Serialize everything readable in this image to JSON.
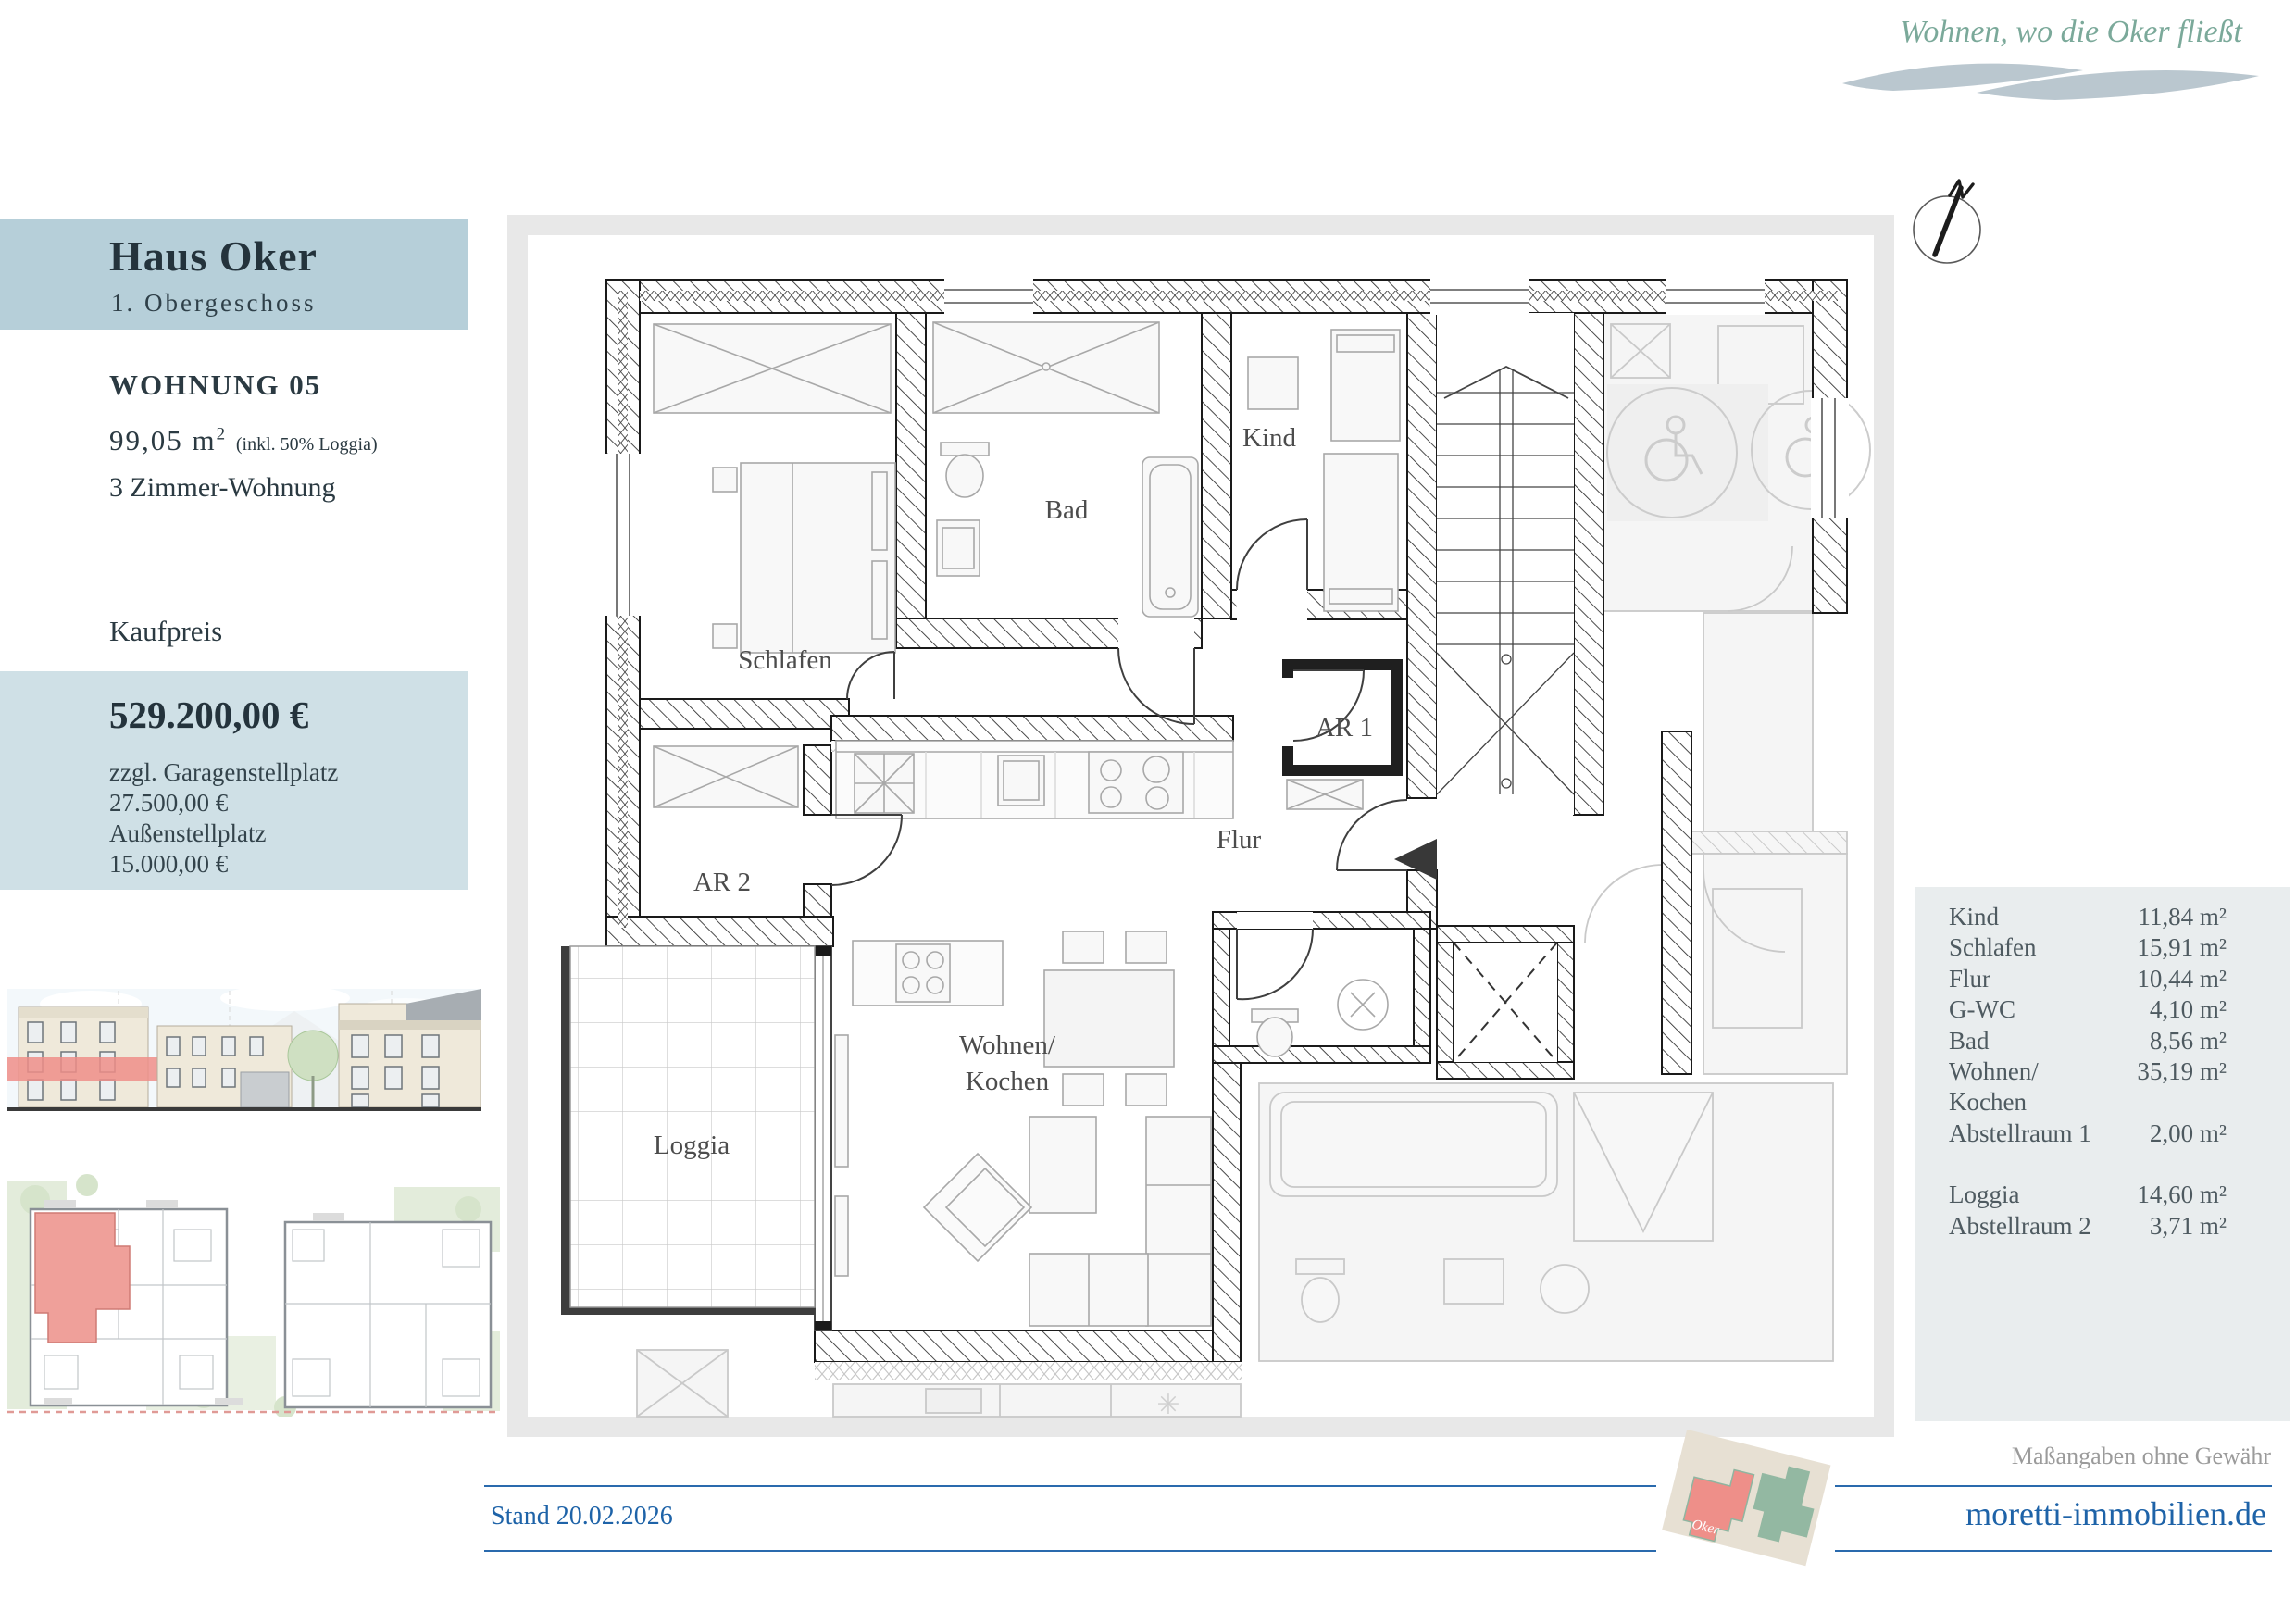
{
  "tagline": "Wohnen, wo die Oker fließt",
  "header": {
    "building": "Haus Oker",
    "floor": "1. Obergeschoss"
  },
  "apartment": {
    "title": "WOHNUNG 05",
    "area_main": "99,05 m",
    "area_sup": "2",
    "area_note": "(inkl. 50% Loggia)",
    "rooms": "3 Zimmer-Wohnung"
  },
  "price": {
    "label": "Kaufpreis",
    "amount": "529.200,00 €",
    "extra1": "zzgl. Garagenstellplatz",
    "extra2": "27.500,00 €",
    "extra3": "Außenstellplatz",
    "extra4": "15.000,00 €"
  },
  "plan_labels": {
    "schlafen": "Schlafen",
    "bad": "Bad",
    "kind": "Kind",
    "ar1": "AR 1",
    "ar2": "AR 2",
    "flur": "Flur",
    "wohnen": "Wohnen/",
    "kochen": "Kochen",
    "loggia": "Loggia"
  },
  "areas": {
    "rows": [
      {
        "label": "Kind",
        "value": "11,84 m²"
      },
      {
        "label": "Schlafen",
        "value": "15,91 m²"
      },
      {
        "label": "Flur",
        "value": "10,44 m²"
      },
      {
        "label": "G-WC",
        "value": "4,10 m²"
      },
      {
        "label": "Bad",
        "value": "8,56 m²"
      },
      {
        "label": "Wohnen/",
        "value": "35,19 m²"
      },
      {
        "label": "Kochen",
        "value": ""
      },
      {
        "label": "Abstellraum 1",
        "value": "2,00 m²"
      },
      {
        "label": "Loggia",
        "value": "14,60 m²"
      },
      {
        "label": "Abstellraum 2",
        "value": "3,71 m²"
      }
    ]
  },
  "footer": {
    "stand": "Stand 20.02.2026",
    "disclaimer": "Maßangaben ohne Gewähr",
    "website": "moretti-immobilien.de",
    "logo_label": "Oker"
  },
  "colors": {
    "header_blue": "#b6cfd9",
    "price_blue": "#cfe0e6",
    "panel_gray": "#e9edee",
    "accent_blue": "#1e63a8",
    "tagline_green": "#7ba99a",
    "highlight_red": "#ef8e88"
  }
}
